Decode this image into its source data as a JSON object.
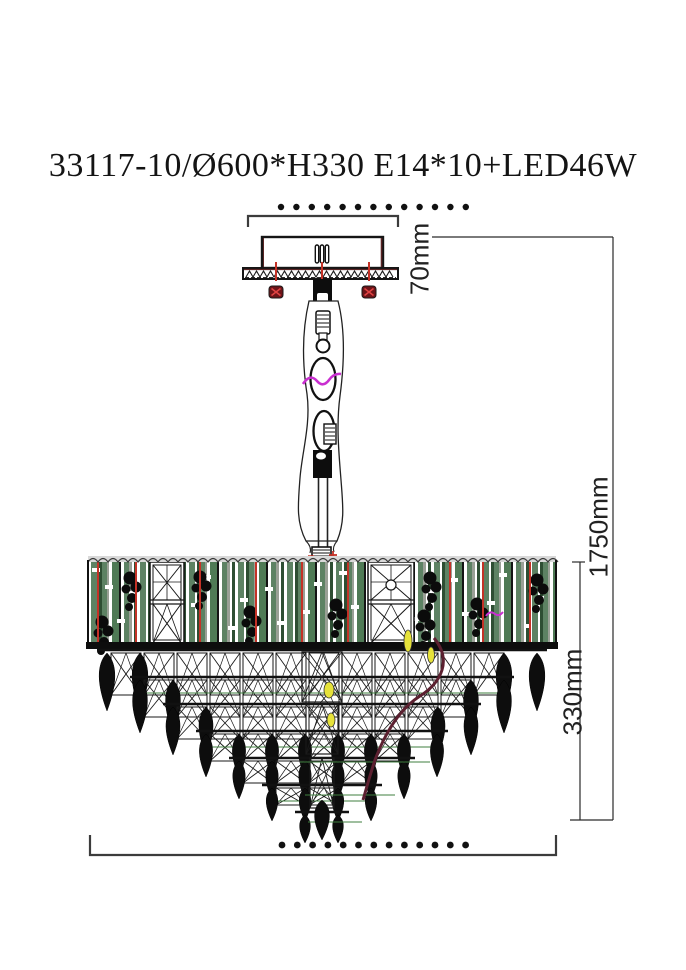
{
  "title": "33117-10/Ø600*H330 E14*10+LED46W",
  "dimensions": {
    "canopy_height": "70mm",
    "total_height": "1750mm",
    "body_height": "330mm"
  },
  "drawing": {
    "colors": {
      "line": "#1a1a1a",
      "bracket": "#3c3c3c",
      "dimension_line": "#2a2a2a",
      "screw_red": "#c43227",
      "screw_head_dark": "#6e1418",
      "screw_head_cross": "#e04343",
      "magenta_accent": "#c92fd0",
      "camo_green": "#5d8263",
      "camo_dark_green": "#2e4e33",
      "camo_olive": "#4f7a55",
      "camo_gray": "#9aa096",
      "maroon_wire": "#5c2030",
      "yellow_accent": "#e6e23a",
      "green_rail": "#3f7f3f",
      "black_fill": "#0d0d0d",
      "plate_maroon": "#5a2424",
      "scallop_gray": "#d9d9d9"
    }
  }
}
